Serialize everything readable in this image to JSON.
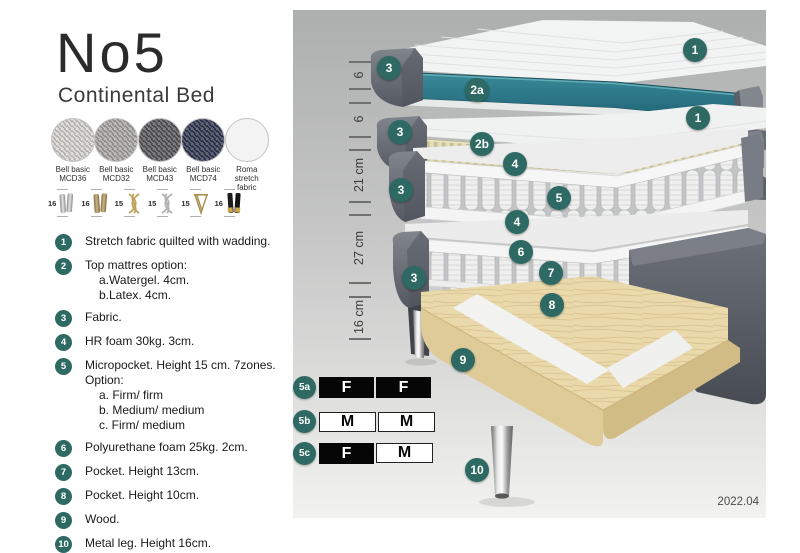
{
  "header": {
    "title": "No5",
    "subtitle": "Continental Bed"
  },
  "fabrics": [
    {
      "line1": "Bell basic",
      "line2": "MCD36",
      "color": "#d8d7d2"
    },
    {
      "line1": "Bell basic",
      "line2": "MCD32",
      "color": "#a9a8a4"
    },
    {
      "line1": "Bell basic",
      "line2": "MCD43",
      "color": "#57575a"
    },
    {
      "line1": "Bell basic",
      "line2": "MCD74",
      "color": "#303652"
    },
    {
      "line1": "Roma",
      "line2": "stretch fabric",
      "color": "#f3f3f3"
    }
  ],
  "legs": [
    {
      "height": "16",
      "style": "cylinder-silver"
    },
    {
      "height": "16",
      "style": "cylinder-brass"
    },
    {
      "height": "15",
      "style": "twisted-gold"
    },
    {
      "height": "15",
      "style": "twisted-silver"
    },
    {
      "height": "15",
      "style": "hairpin"
    },
    {
      "height": "16",
      "style": "cylinder-black-gold"
    }
  ],
  "features": [
    {
      "num": "1",
      "text": "Stretch fabric quilted with wadding."
    },
    {
      "num": "2",
      "text": "Top mattres option:",
      "subs": [
        "a.Watergel. 4cm.",
        "b.Latex. 4cm."
      ]
    },
    {
      "num": "3",
      "text": "Fabric."
    },
    {
      "num": "4",
      "text": "HR foam 30kg. 3cm."
    },
    {
      "num": "5",
      "text": "Micropocket. Height 15 cm. 7zones. Option:",
      "subs": [
        "a. Firm/ firm",
        "b. Medium/ medium",
        "c. Firm/ medium"
      ]
    },
    {
      "num": "6",
      "text": "Polyurethane foam 25kg. 2cm."
    },
    {
      "num": "7",
      "text": "Pocket. Height 13cm."
    },
    {
      "num": "8",
      "text": "Pocket. Height 10cm."
    },
    {
      "num": "9",
      "text": "Wood."
    },
    {
      "num": "10",
      "text": "Metal leg. Height 16cm."
    }
  ],
  "diagram": {
    "measurements": [
      "6",
      "6",
      "21 cm",
      "27 cm",
      "16 cm"
    ],
    "callouts": {
      "one": "1",
      "two_a": "2a",
      "two_b": "2b",
      "three": "3",
      "four": "4",
      "five": "5",
      "six": "6",
      "seven": "7",
      "eight": "8",
      "nine": "9",
      "ten": "10"
    },
    "firmness_table": {
      "rows": [
        {
          "label": "5a",
          "cells": [
            {
              "text": "F",
              "variant": "dark"
            },
            {
              "text": "F",
              "variant": "dark"
            }
          ]
        },
        {
          "label": "5b",
          "cells": [
            {
              "text": "M",
              "variant": "light"
            },
            {
              "text": "M",
              "variant": "light"
            }
          ]
        },
        {
          "label": "5c",
          "cells": [
            {
              "text": "F",
              "variant": "dark"
            },
            {
              "text": "M",
              "variant": "light"
            }
          ]
        }
      ]
    },
    "version": "2022.04"
  },
  "colors": {
    "accent": "#2e6a63",
    "teal_core": "#2b7d8d",
    "latex_layer": "#ded7ae",
    "wood": "#e8d8aa",
    "shell_gray": "#6b6f76",
    "panel_top": "#adafae",
    "panel_bottom": "#f2f2f0"
  }
}
